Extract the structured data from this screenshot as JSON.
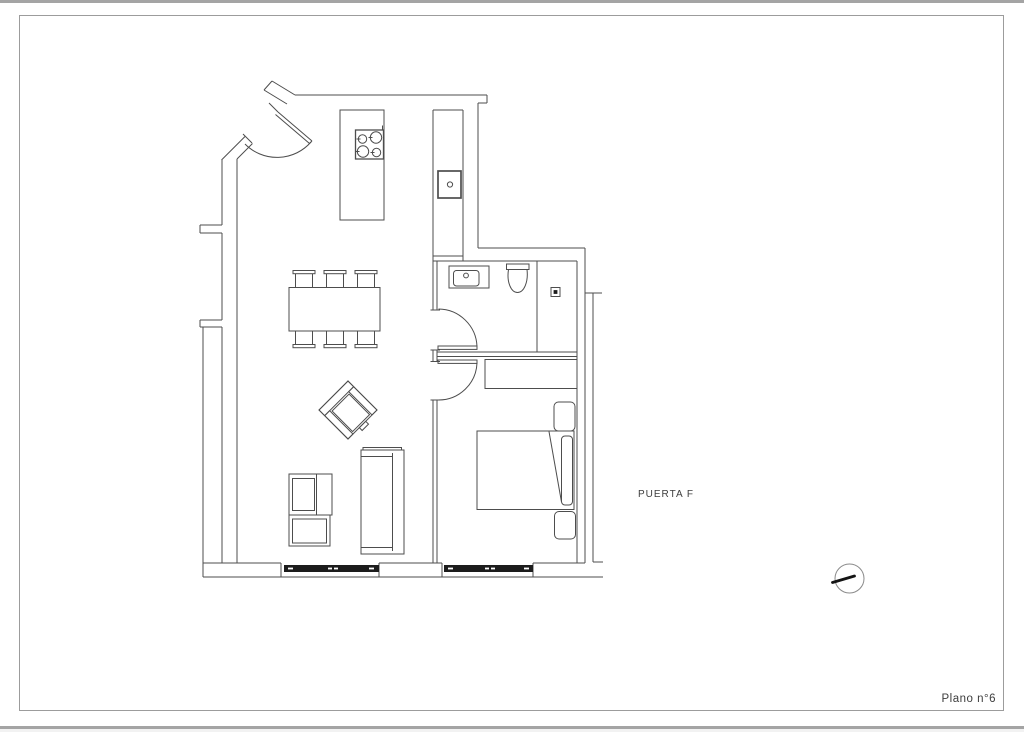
{
  "sheet": {
    "label_door": "PUERTA F",
    "label_sheet_number": "Plano n°6"
  },
  "colors": {
    "line": "#4d4d4d",
    "frame": "#9c9c9c",
    "viewer_edge": "#a4a4a4",
    "window_fill": "#1c1c1c",
    "needle": "#141414",
    "text": "#3d3d3d",
    "paper": "#ffffff"
  }
}
